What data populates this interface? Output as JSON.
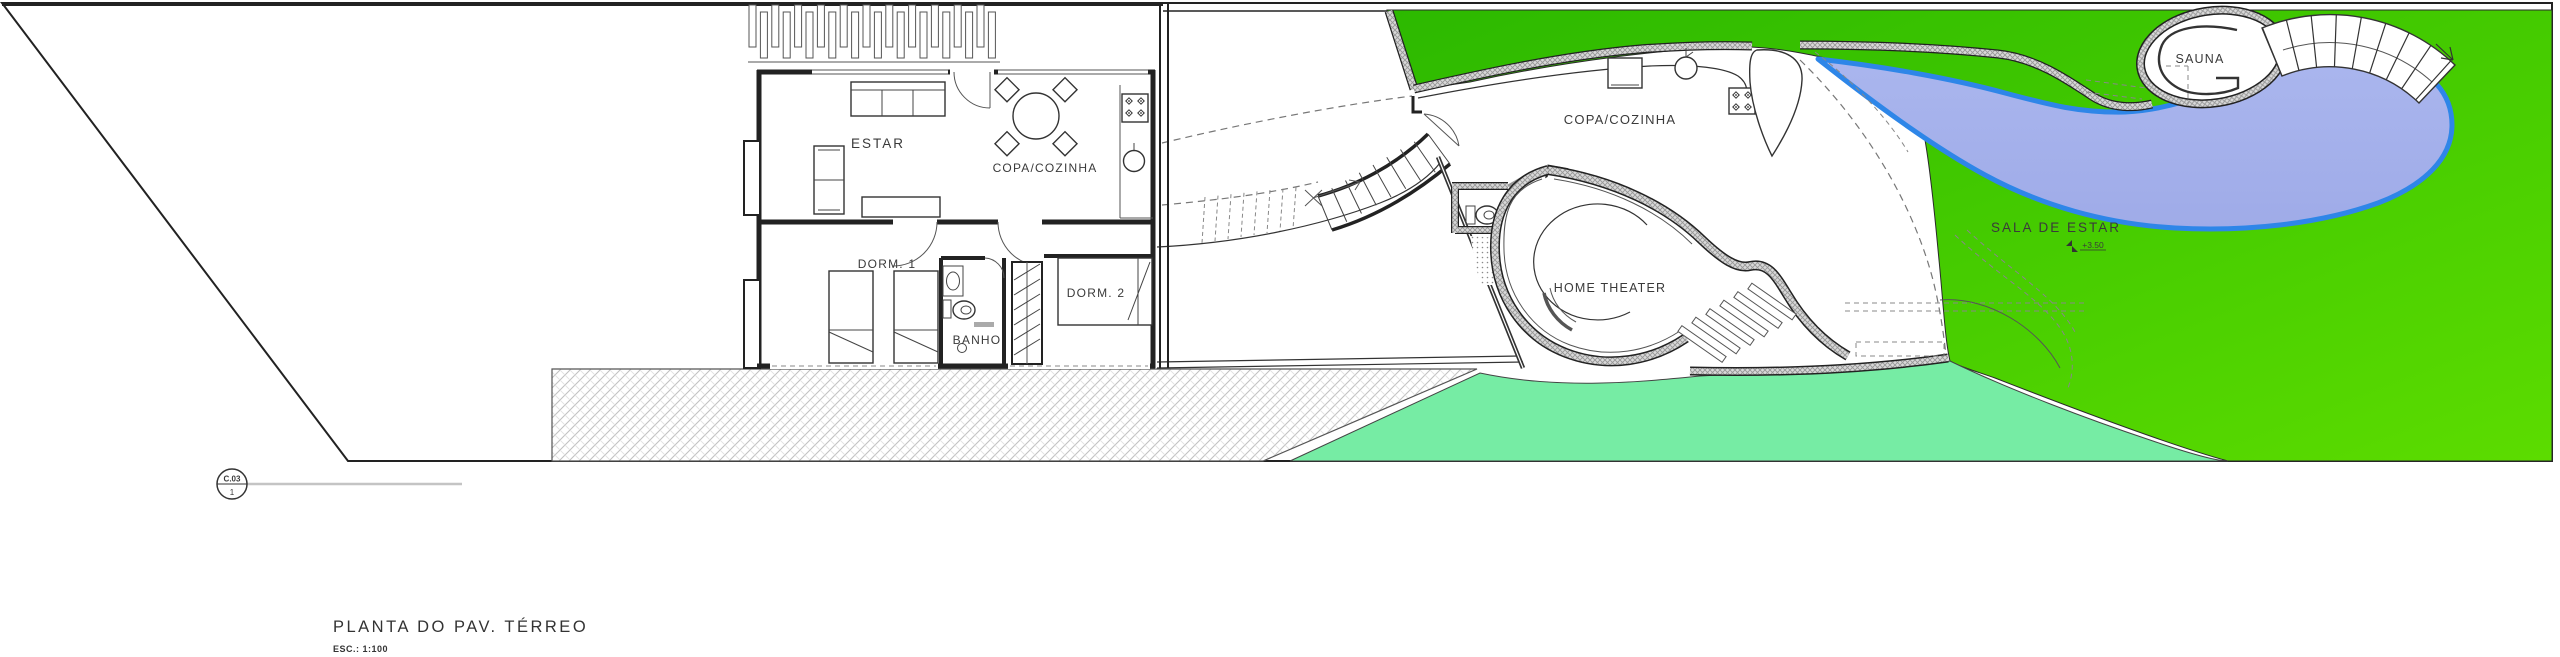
{
  "plan_title": {
    "label": "PLANTA DO PAV. TÉRREO",
    "scale": "ESC.: 1:100"
  },
  "section_callout": {
    "code": "C.03",
    "sheet": "1"
  },
  "annex_rooms": {
    "estar": "ESTAR",
    "copa_cozinha": "COPA/COZINHA",
    "dorm1": "DORM. 1",
    "dorm2": "DORM. 2",
    "banho": "BANHO"
  },
  "main_rooms": {
    "copa_cozinha": "COPA/COZINHA",
    "sala_de_estar": "SALA DE ESTAR",
    "sala_level": "+3.50",
    "home_theater": "HOME THEATER",
    "sauna": "SAUNA"
  },
  "colors": {
    "lawn_dark": "#2cb900",
    "lawn_light": "#5cdc00",
    "mint": "#76eca4",
    "pool_fill": "#9fabe8",
    "pool_fill_light": "#aab6ee",
    "pool_edge": "#2e86e8",
    "paper": "#ffffff",
    "line": "#2e2e2e"
  }
}
